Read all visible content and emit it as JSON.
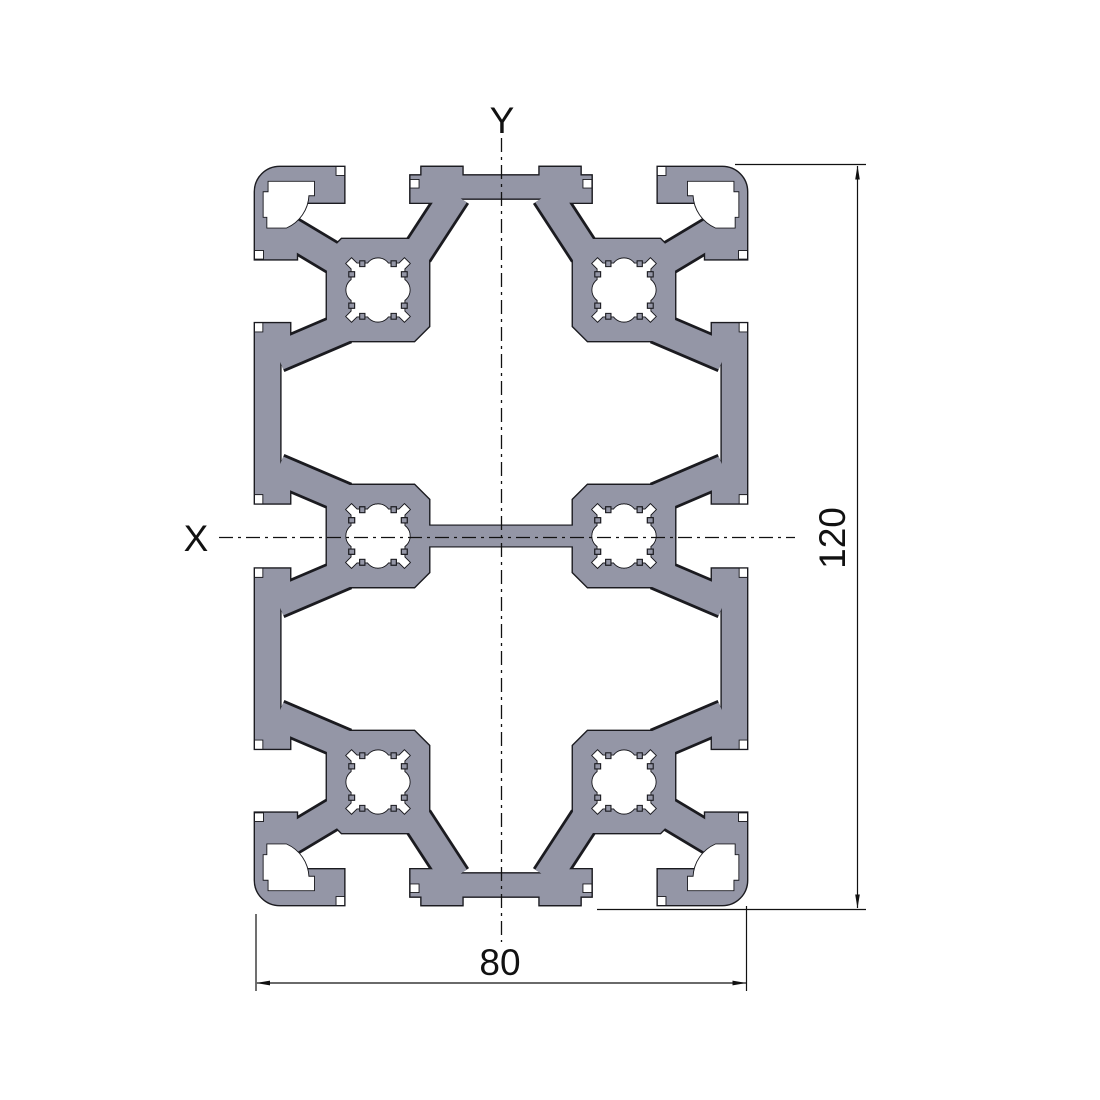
{
  "drawing": {
    "title": "aluminium-extrusion-profile-cross-section",
    "axes": {
      "x_label": "X",
      "y_label": "Y"
    },
    "dimensions": {
      "width": {
        "value": "80"
      },
      "height": {
        "value": "120"
      }
    },
    "colors": {
      "background": "#ffffff",
      "profile_fill": "#9496a6",
      "edge": "#1b1b20",
      "annotation": "#111111"
    }
  }
}
